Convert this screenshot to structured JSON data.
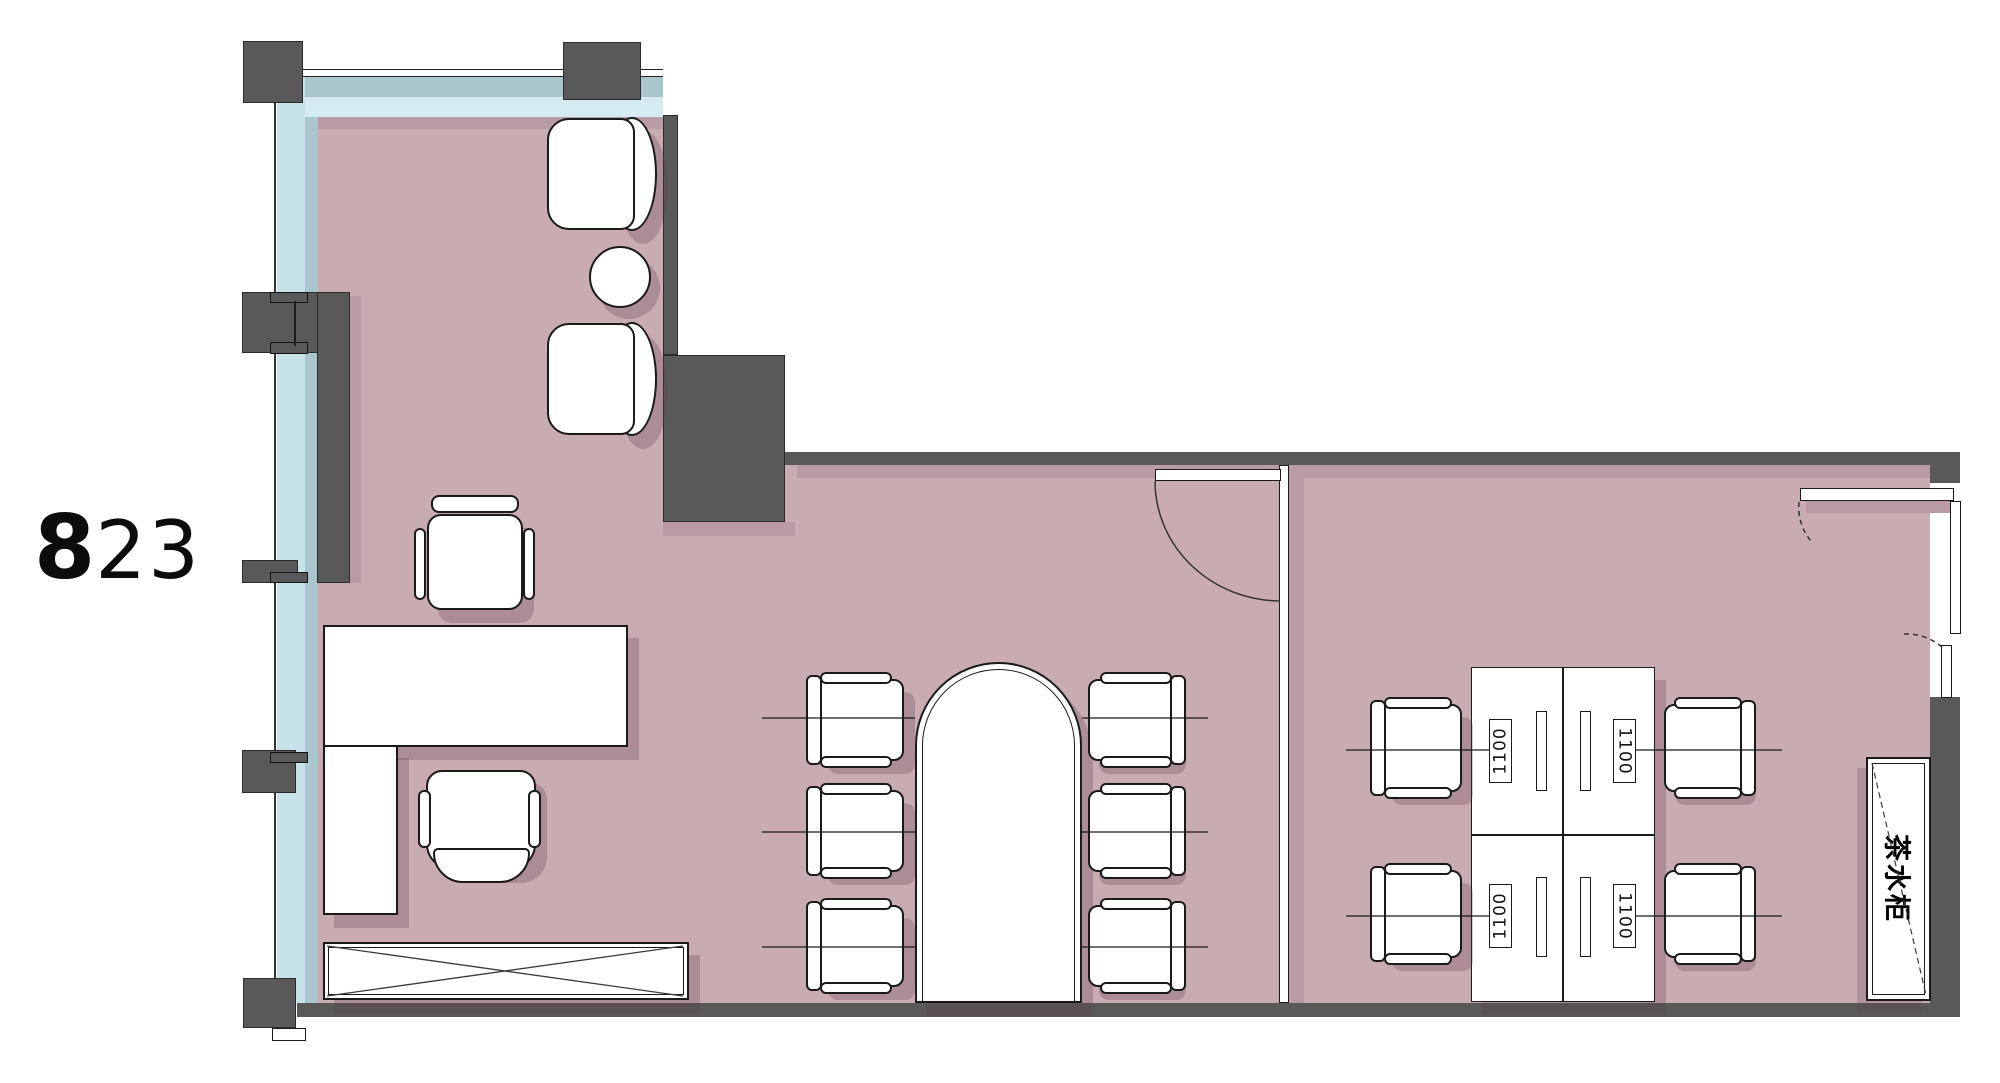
{
  "title": "office-unit-floor-plan",
  "unit_label": {
    "big": "8",
    "small": "23"
  },
  "right_office": {
    "desk_labels": [
      "1100",
      "1100",
      "1100",
      "1100"
    ],
    "cabinet_label": "茶水柜"
  },
  "palette": {
    "wall": "#595959",
    "floor": "#c9abb2",
    "floor_shadow": "#b89ba6",
    "glass_outer": "#a9c6cc",
    "glass_inner": "#d3ebf1",
    "line": "#1a1a1a",
    "furniture": "#ffffff"
  },
  "legend": {
    "rooms": [
      "executive-office",
      "meeting-area",
      "open-office"
    ],
    "furniture": [
      "lounge-chairs",
      "round-side-table",
      "executive-desk",
      "task-chairs",
      "credenza",
      "meeting-table",
      "meeting-chairs",
      "workstation-cluster",
      "tea-cabinet"
    ]
  }
}
